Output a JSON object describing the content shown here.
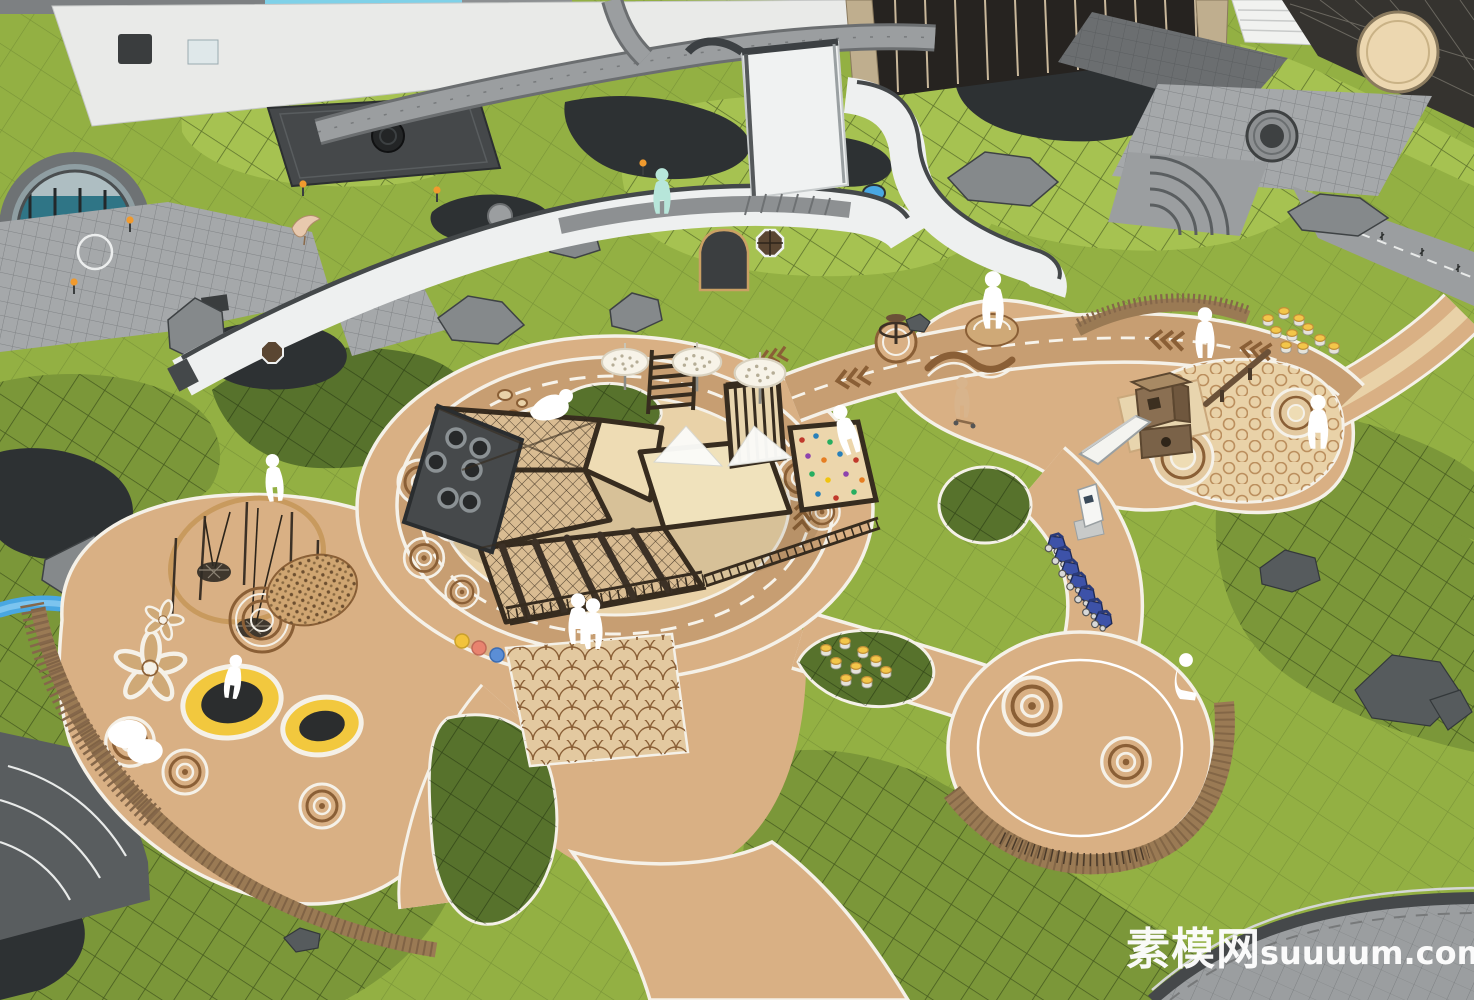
{
  "watermark": {
    "text_cn": "素模网",
    "text_en": "suuuum.com"
  },
  "palette": {
    "grass_base": "#93b043",
    "grass_flat": "#a6c251",
    "grass_mid": "#7b9739",
    "grass_dark": "#57722c",
    "tan": "#d9b084",
    "tan_light": "#e9d2a8",
    "tan_track": "#c79e72",
    "brown": "#8a5f36",
    "curb": "#f5f1e8",
    "wood": "#9a7a54",
    "wood_dark": "#6b5138",
    "frame": "#372c1f",
    "wall_white": "#eef0f0",
    "wall_cap": "#44484a",
    "gray_paving": "#a5a8aa",
    "gray_road": "#9b9ea0",
    "gray_dark": "#595d5f",
    "water_dark": "#2d3133",
    "stream_blue": "#49a7e2",
    "rock_gray": "#85898b",
    "trampoline_yellow": "#f2c83e",
    "trampoline_black": "#2b2d2e",
    "stroller_blue": "#3d52a8",
    "figure_white": "#ffffff",
    "figure_teal": "#b7e6da",
    "lamp_orange": "#f09a2e",
    "pool_cyan": "#7fd1e8",
    "watermark": "#ffffff"
  },
  "scene": {
    "style": "aerial SketchUp-style landscape render",
    "features": [
      "children playground with ring running track",
      "timber climbing structure",
      "tire wall",
      "climbing nets",
      "rock climbing wall with colored holds",
      "slide tower with sand pits",
      "circular swing ring",
      "trampolines",
      "shade canopy umbrellas",
      "serpentine white garden wall with arched door",
      "curved timber benches",
      "parked blue strollers",
      "log stool clusters",
      "lawn mounds with crosshatch turf",
      "rock groupings",
      "dark reflecting ponds",
      "blue stream",
      "crane sculpture",
      "gray paved roads and plazas"
    ],
    "figure_counts": {
      "white_silhouettes": 12,
      "teal_figure": 1,
      "child_on_scooter": 1
    }
  }
}
